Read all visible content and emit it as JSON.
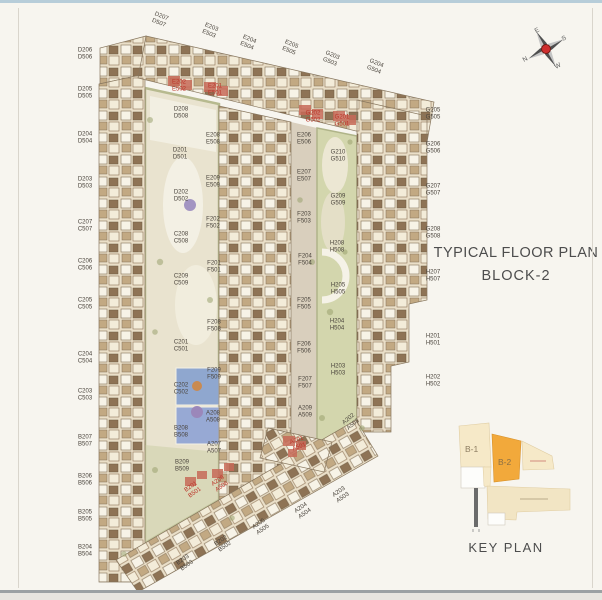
{
  "title": {
    "line1": "TYPICAL FLOOR PLAN",
    "line2": "BLOCK-2"
  },
  "compass": {
    "n": "N",
    "e": "E",
    "s": "S",
    "w": "W"
  },
  "key_plan": {
    "title": "KEY PLAN",
    "b1": "B-1",
    "b2": "B-2",
    "highlight_color": "#f2a93b",
    "block_color": "#f6e9c8"
  },
  "colors": {
    "label_dark": "#4a443c",
    "label_red": "#bc352a",
    "building_base": "#eadfc8",
    "garden": "#e9e3cf",
    "green": "#ccd0a8",
    "pool_blue": "#8fa7cf",
    "compass_red": "#cf2e2e"
  },
  "plan": {
    "labels": [
      {
        "t1": "D206",
        "t2": "D506",
        "x": 85,
        "y": 54
      },
      {
        "t1": "D205",
        "t2": "D505",
        "x": 85,
        "y": 93
      },
      {
        "t1": "D204",
        "t2": "D504",
        "x": 85,
        "y": 138
      },
      {
        "t1": "D203",
        "t2": "D503",
        "x": 85,
        "y": 183
      },
      {
        "t1": "C207",
        "t2": "C507",
        "x": 85,
        "y": 226
      },
      {
        "t1": "C206",
        "t2": "C506",
        "x": 85,
        "y": 265
      },
      {
        "t1": "C205",
        "t2": "C505",
        "x": 85,
        "y": 304
      },
      {
        "t1": "C204",
        "t2": "C504",
        "x": 85,
        "y": 358
      },
      {
        "t1": "C203",
        "t2": "C503",
        "x": 85,
        "y": 395
      },
      {
        "t1": "B207",
        "t2": "B507",
        "x": 85,
        "y": 441
      },
      {
        "t1": "B206",
        "t2": "B506",
        "x": 85,
        "y": 480
      },
      {
        "t1": "B205",
        "t2": "B505",
        "x": 85,
        "y": 516
      },
      {
        "t1": "B204",
        "t2": "B504",
        "x": 85,
        "y": 551
      },
      {
        "t1": "D207",
        "t2": "D507",
        "x": 160,
        "y": 20,
        "rot": 22
      },
      {
        "t1": "E203",
        "t2": "E503",
        "x": 210,
        "y": 31,
        "rot": 22
      },
      {
        "t1": "E204",
        "t2": "E504",
        "x": 248,
        "y": 43,
        "rot": 22
      },
      {
        "t1": "E205",
        "t2": "E505",
        "x": 290,
        "y": 48,
        "rot": 22
      },
      {
        "t1": "G203",
        "t2": "G503",
        "x": 331,
        "y": 59,
        "rot": 22
      },
      {
        "t1": "G204",
        "t2": "G504",
        "x": 375,
        "y": 67,
        "rot": 22
      },
      {
        "t1": "G205",
        "t2": "G505",
        "x": 433,
        "y": 114
      },
      {
        "t1": "G206",
        "t2": "G506",
        "x": 433,
        "y": 148
      },
      {
        "t1": "G207",
        "t2": "G507",
        "x": 433,
        "y": 190
      },
      {
        "t1": "G208",
        "t2": "G508",
        "x": 433,
        "y": 233
      },
      {
        "t1": "H207",
        "t2": "H507",
        "x": 433,
        "y": 276
      },
      {
        "t1": "H201",
        "t2": "H501",
        "x": 433,
        "y": 340
      },
      {
        "t1": "H202",
        "t2": "H502",
        "x": 433,
        "y": 381
      },
      {
        "t1": "D208",
        "t2": "D508",
        "x": 181,
        "y": 113
      },
      {
        "t1": "E208",
        "t2": "E508",
        "x": 213,
        "y": 139
      },
      {
        "t1": "D201",
        "t2": "D501",
        "x": 180,
        "y": 154
      },
      {
        "t1": "E209",
        "t2": "E509",
        "x": 213,
        "y": 182
      },
      {
        "t1": "D202",
        "t2": "D502",
        "x": 181,
        "y": 196
      },
      {
        "t1": "F202",
        "t2": "F502",
        "x": 213,
        "y": 223
      },
      {
        "t1": "C208",
        "t2": "C508",
        "x": 181,
        "y": 238
      },
      {
        "t1": "F201",
        "t2": "F501",
        "x": 214,
        "y": 267
      },
      {
        "t1": "C209",
        "t2": "C509",
        "x": 181,
        "y": 280
      },
      {
        "t1": "F208",
        "t2": "F508",
        "x": 214,
        "y": 326
      },
      {
        "t1": "C201",
        "t2": "C501",
        "x": 181,
        "y": 346
      },
      {
        "t1": "F209",
        "t2": "F509",
        "x": 214,
        "y": 374
      },
      {
        "t1": "C202",
        "t2": "C502",
        "x": 181,
        "y": 389
      },
      {
        "t1": "A208",
        "t2": "A508",
        "x": 213,
        "y": 417
      },
      {
        "t1": "B208",
        "t2": "B508",
        "x": 181,
        "y": 432
      },
      {
        "t1": "A207",
        "t2": "A507",
        "x": 214,
        "y": 448
      },
      {
        "t1": "B209",
        "t2": "B509",
        "x": 182,
        "y": 466
      },
      {
        "t1": "E206",
        "t2": "E506",
        "x": 304,
        "y": 139
      },
      {
        "t1": "E207",
        "t2": "E507",
        "x": 304,
        "y": 176
      },
      {
        "t1": "F203",
        "t2": "F503",
        "x": 304,
        "y": 218
      },
      {
        "t1": "F204",
        "t2": "F504",
        "x": 305,
        "y": 260
      },
      {
        "t1": "F205",
        "t2": "F505",
        "x": 304,
        "y": 304
      },
      {
        "t1": "F206",
        "t2": "F506",
        "x": 304,
        "y": 348
      },
      {
        "t1": "F207",
        "t2": "F507",
        "x": 305,
        "y": 383
      },
      {
        "t1": "A209",
        "t2": "A509",
        "x": 305,
        "y": 412
      },
      {
        "t1": "G210",
        "t2": "G510",
        "x": 338,
        "y": 156
      },
      {
        "t1": "G209",
        "t2": "G509",
        "x": 338,
        "y": 200
      },
      {
        "t1": "H208",
        "t2": "H508",
        "x": 337,
        "y": 247
      },
      {
        "t1": "H205",
        "t2": "H505",
        "x": 338,
        "y": 289
      },
      {
        "t1": "H204",
        "t2": "H504",
        "x": 337,
        "y": 325
      },
      {
        "t1": "H203",
        "t2": "H503",
        "x": 338,
        "y": 370
      },
      {
        "t1": "E202",
        "t2": "E502",
        "x": 179,
        "y": 86,
        "red": true
      },
      {
        "t1": "E201",
        "t2": "E501",
        "x": 215,
        "y": 90,
        "red": true
      },
      {
        "t1": "G202",
        "t2": "G502",
        "x": 313,
        "y": 117,
        "red": true
      },
      {
        "t1": "G201",
        "t2": "G501",
        "x": 342,
        "y": 121,
        "red": true
      },
      {
        "t1": "A201",
        "t2": "A501",
        "x": 298,
        "y": 444,
        "rot": -20,
        "red": true
      },
      {
        "t1": "B201",
        "t2": "B501",
        "x": 193,
        "y": 490,
        "rot": -35,
        "red": true
      },
      {
        "t1": "A206",
        "t2": "A506",
        "x": 220,
        "y": 484,
        "rot": -35,
        "red": true
      },
      {
        "t1": "B203",
        "t2": "B503",
        "x": 185,
        "y": 563,
        "rot": -35
      },
      {
        "t1": "B202",
        "t2": "B502",
        "x": 223,
        "y": 544,
        "rot": -35
      },
      {
        "t1": "A205",
        "t2": "A505",
        "x": 261,
        "y": 527,
        "rot": -35
      },
      {
        "t1": "A204",
        "t2": "A504",
        "x": 303,
        "y": 511,
        "rot": -35
      },
      {
        "t1": "A203",
        "t2": "A503",
        "x": 341,
        "y": 495,
        "rot": -35
      },
      {
        "t1": "A202",
        "t2": "A502",
        "x": 351,
        "y": 422,
        "rot": -40
      }
    ]
  }
}
